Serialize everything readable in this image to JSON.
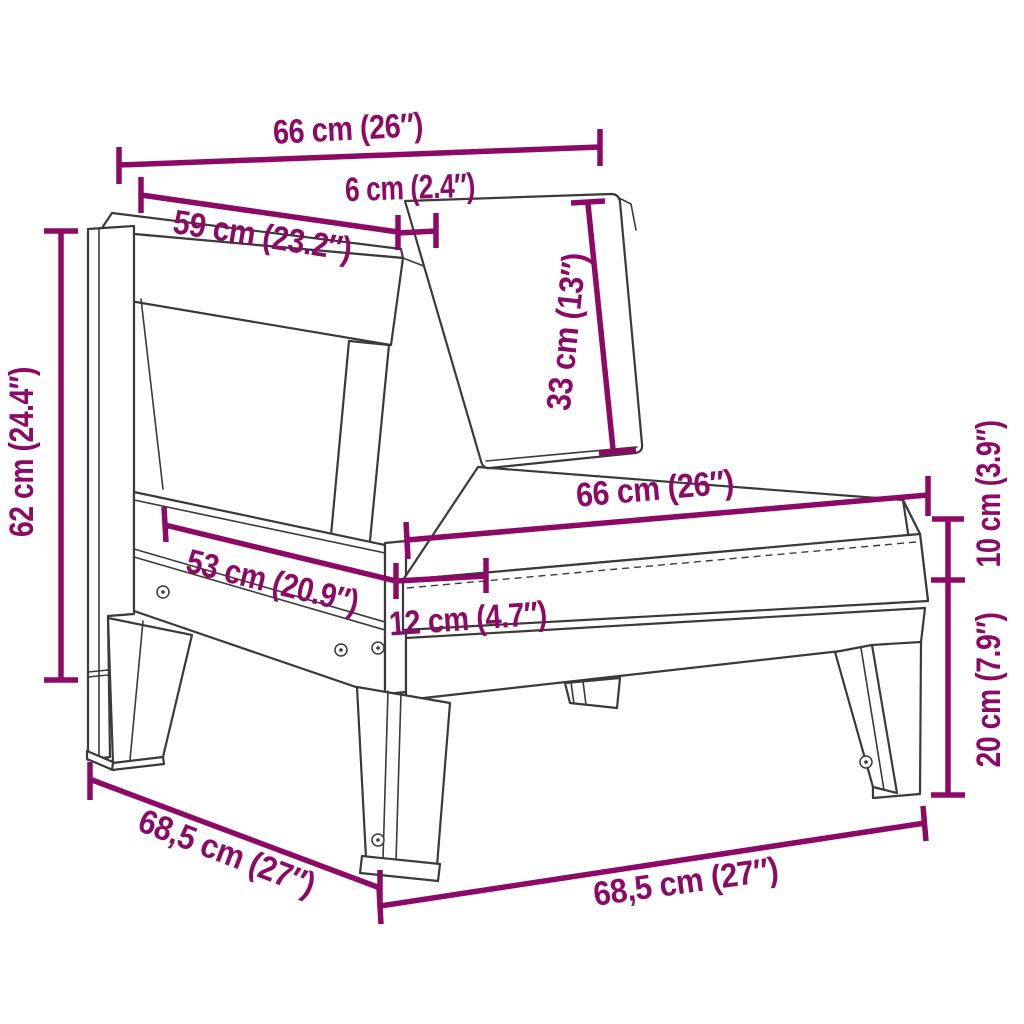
{
  "page": {
    "background": "#ffffff",
    "kind": "product-dimension-diagram",
    "subject": "wooden garden chair sofa-section line drawing with dimension callouts"
  },
  "style": {
    "dimension_color": "#8C0A66",
    "outline_color": "#3a3a3a"
  },
  "dimensions": {
    "top_width": {
      "label": "66 cm (26″)",
      "cm": "66",
      "inch": "26"
    },
    "back_panel_width": {
      "label": "59 cm (23.2″)",
      "cm": "59",
      "inch": "23.2"
    },
    "back_rail_thickness": {
      "label": "6 cm (2.4″)",
      "cm": "6",
      "inch": "2.4"
    },
    "backrest_height": {
      "label": "33 cm (13″)",
      "cm": "33",
      "inch": "13"
    },
    "seat_width": {
      "label": "66 cm (26″)",
      "cm": "66",
      "inch": "26"
    },
    "side_rail_length": {
      "label": "53 cm (20.9″)",
      "cm": "53",
      "inch": "20.9"
    },
    "post_offset": {
      "label": "12 cm (4.7″)",
      "cm": "12",
      "inch": "4.7"
    },
    "frame_height": {
      "label": "62 cm (24.4″)",
      "cm": "62",
      "inch": "24.4"
    },
    "cushion_thickness": {
      "label": "10 cm (3.9″)",
      "cm": "10",
      "inch": "3.9"
    },
    "leg_height": {
      "label": "20 cm (7.9″)",
      "cm": "20",
      "inch": "7.9"
    },
    "depth": {
      "label": "68,5 cm (27″)",
      "cm": "68,5",
      "inch": "27"
    },
    "bottom_width": {
      "label": "68,5 cm (27″)",
      "cm": "68,5",
      "inch": "27"
    }
  }
}
